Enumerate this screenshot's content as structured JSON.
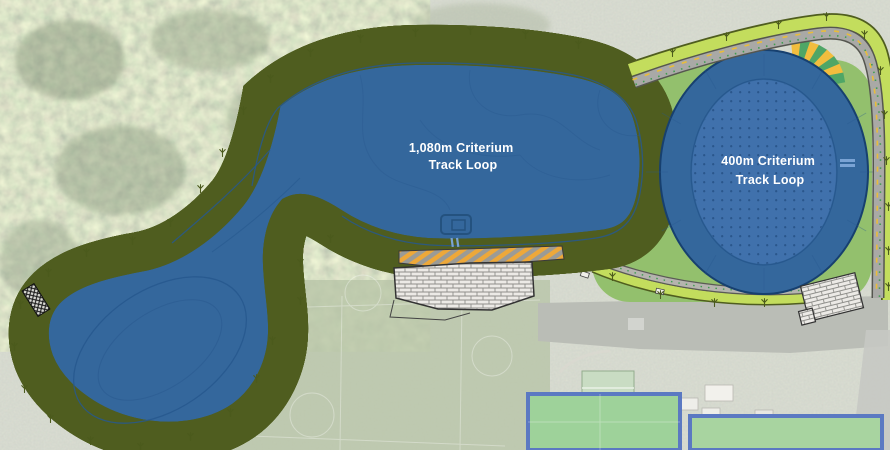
{
  "map": {
    "type": "aerial-site-plan",
    "tracks": [
      {
        "id": "track-1080",
        "label_line1": "1,080m Criterium",
        "label_line2": "Track Loop"
      },
      {
        "id": "track-400",
        "label_line1": "400m Criterium",
        "label_line2": "Track Loop"
      }
    ],
    "colors": {
      "track_overlay_blue": "#34679c",
      "track_infield_blue": "#4071ac",
      "track_inner_line": "#27588e",
      "verge_green": "#c3dd5d",
      "lawn_green": "#93c06d",
      "road_grey": "#a9a9a6",
      "stripe_orange": "#eda83a",
      "fan_yellow": "#f2bd3e",
      "fan_green": "#4fa666",
      "label_white": "#ffffff"
    },
    "icons": {
      "tree_marker": "tree-icon",
      "paved_area": "brick-hatch",
      "footbridge": "crosshatch"
    }
  }
}
